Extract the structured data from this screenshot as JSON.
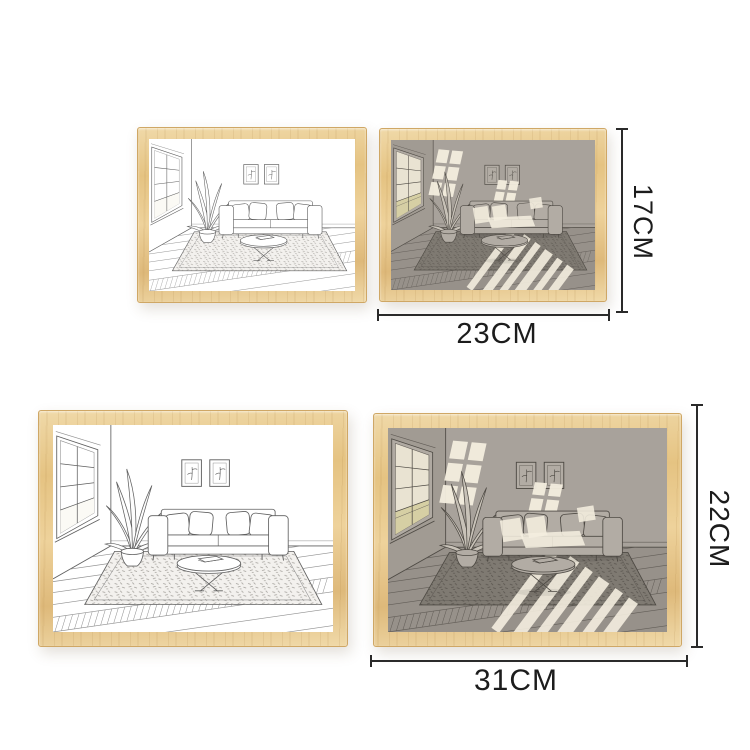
{
  "dimensions": {
    "small": {
      "height": "17CM",
      "width": "23CM"
    },
    "large": {
      "height": "22CM",
      "width": "31CM"
    }
  },
  "frames": [
    {
      "name": "small-line",
      "style": "line-art"
    },
    {
      "name": "small-lit",
      "style": "backlit"
    },
    {
      "name": "large-line",
      "style": "line-art"
    },
    {
      "name": "large-lit",
      "style": "backlit"
    }
  ],
  "colors": {
    "frame_wood_1": "#f0d9a8",
    "frame_wood_2": "#e5c382",
    "frame_wood_3": "#eed29b",
    "frame_wood_4": "#deb97a",
    "frame_wood_edge": "#cfa765",
    "dimension_line": "#2a2a2a",
    "label_text": "#1c1c1c",
    "scene_line": {
      "wall": "#ffffff",
      "wall_left": "#ffffff",
      "floor": "#ffffff",
      "stroke": "#5f5f5f",
      "stroke_soft": "#8f8f8f",
      "object_fill": "#ffffff",
      "leaf_fill": "#fdfdfd",
      "rug_fill": "#f3f1ee",
      "rug_speckle": "#a29f9a",
      "window_frame": "#ffffff",
      "pane": "#ffffff",
      "pane_low": "#fbfaf5",
      "light_patch": ""
    },
    "scene_shade": {
      "wall": "#a8a29b",
      "wall_left": "#a19b93",
      "floor": "#97918a",
      "stroke": "#4d4943",
      "stroke_soft": "#625d57",
      "object_fill": "#b2aca4",
      "leaf_fill": "#c8c2b8",
      "rug_fill": "#7f7a72",
      "rug_speckle": "#58534d",
      "window_frame": "#b0aaa2",
      "pane": "#e9e3d2",
      "pane_low": "#d6cfa4",
      "light_patch": "#f4eedf"
    }
  }
}
